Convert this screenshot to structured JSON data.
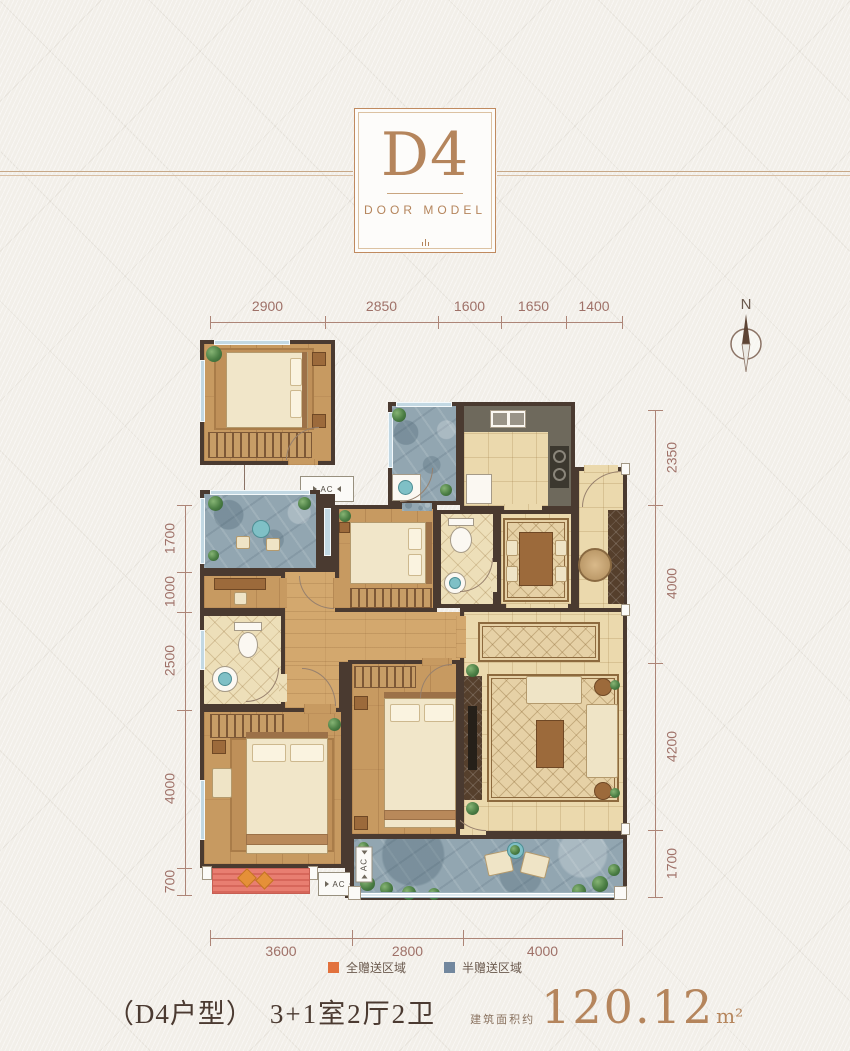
{
  "header": {
    "badge": "D4",
    "subtitle": "DOOR MODEL"
  },
  "compass": {
    "label": "N"
  },
  "dimensions": {
    "top": [
      "2900",
      "2850",
      "1600",
      "1650",
      "1400"
    ],
    "left": [
      "1700",
      "1000",
      "2500",
      "4000",
      "700"
    ],
    "right": [
      "2350",
      "4000",
      "4200",
      "1700"
    ],
    "bottom": [
      "3600",
      "2800",
      "4000"
    ]
  },
  "plan": {
    "ac_label": "AC"
  },
  "legend": {
    "items": [
      {
        "label": "全赠送区域",
        "color": "#e2713c"
      },
      {
        "label": "半赠送区域",
        "color": "#72879e"
      }
    ]
  },
  "footer": {
    "unit_name": "（D4户型）",
    "layout_desc": "3+1室2厅2卫",
    "area_prefix": "建筑面积约",
    "area_value": "120.12",
    "area_unit": "m²"
  },
  "colors": {
    "accent_copper": "#b5855c",
    "dimension_text": "#9f7168",
    "wall": "#4a3a30",
    "full_gift": "#e2713c",
    "half_gift": "#72879e",
    "wood_floor": "#c79a61",
    "tile_floor": "#ebd9ad",
    "stone_floor": "#92a6b1"
  }
}
